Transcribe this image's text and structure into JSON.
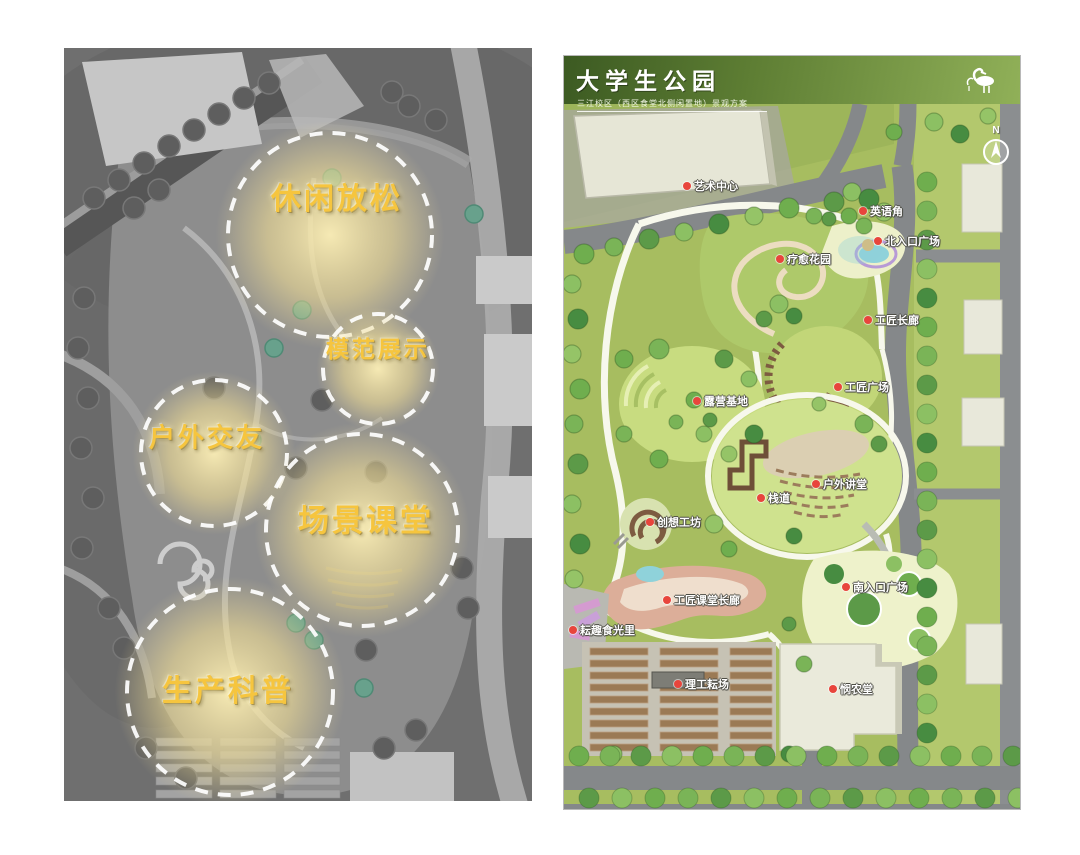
{
  "page": {
    "description": "两张并列的景观设计总平面图：左侧为灰色功能分区意向图，右侧为大学生公园彩色景观方案总平面图"
  },
  "left_panel": {
    "board_name": "功能分区意向图",
    "label_color": "#f6c53e",
    "zones": [
      {
        "label": "休闲放松",
        "x": 273,
        "y": 148,
        "font_size": 30,
        "circle": {
          "cx": 266,
          "cy": 187,
          "r": 102
        }
      },
      {
        "label": "模范展示",
        "x": 314,
        "y": 299,
        "font_size": 23,
        "circle": {
          "cx": 314,
          "cy": 321,
          "r": 55
        }
      },
      {
        "label": "户外交友",
        "x": 143,
        "y": 388,
        "font_size": 26,
        "circle": {
          "cx": 150,
          "cy": 405,
          "r": 73
        }
      },
      {
        "label": "场景课堂",
        "x": 302,
        "y": 470,
        "font_size": 31,
        "circle": {
          "cx": 298,
          "cy": 482,
          "r": 96
        }
      },
      {
        "label": "生产科普",
        "x": 164,
        "y": 640,
        "font_size": 30,
        "circle": {
          "cx": 166,
          "cy": 644,
          "r": 103
        }
      }
    ]
  },
  "right_panel": {
    "header": {
      "title": "大学生公园",
      "subtitle": "三江校区（西区食堂北侧闲置地）景观方案",
      "logo": "flamingo-icon",
      "bg_dark": "#3c5a22",
      "bg_light": "#90b058"
    },
    "compass_label": "N",
    "marker_color": "#e8453c",
    "labels": [
      {
        "text": "艺术中心",
        "x": 119,
        "y": 82
      },
      {
        "text": "英语角",
        "x": 295,
        "y": 107
      },
      {
        "text": "北入口广场",
        "x": 310,
        "y": 137
      },
      {
        "text": "疗愈花园",
        "x": 212,
        "y": 155
      },
      {
        "text": "工匠长廊",
        "x": 300,
        "y": 216
      },
      {
        "text": "工匠广场",
        "x": 270,
        "y": 283
      },
      {
        "text": "露营基地",
        "x": 129,
        "y": 297
      },
      {
        "text": "户外讲堂",
        "x": 248,
        "y": 380
      },
      {
        "text": "栈道",
        "x": 193,
        "y": 394
      },
      {
        "text": "创想工坊",
        "x": 82,
        "y": 418
      },
      {
        "text": "南入口广场",
        "x": 278,
        "y": 483
      },
      {
        "text": "工匠课堂长廊",
        "x": 99,
        "y": 496
      },
      {
        "text": "耘趣食光里",
        "x": 5,
        "y": 526
      },
      {
        "text": "理工耘场",
        "x": 110,
        "y": 580
      },
      {
        "text": "悯农堂",
        "x": 265,
        "y": 585
      }
    ]
  }
}
